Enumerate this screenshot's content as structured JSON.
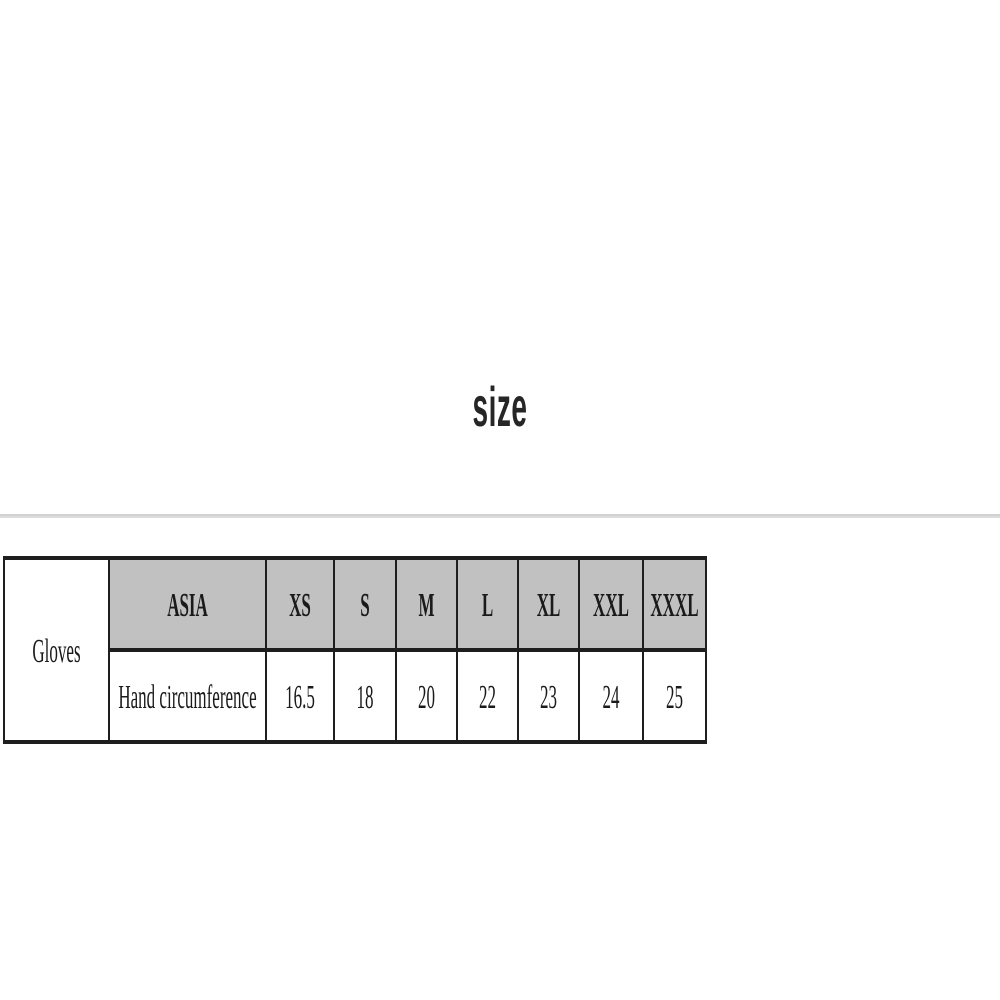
{
  "page": {
    "background": "#ffffff"
  },
  "title": {
    "text": "size",
    "color": "#262626"
  },
  "divider": {
    "color": "#dcdcdc"
  },
  "size_chart": {
    "category": "Gloves",
    "region_header": "ASIA",
    "size_labels": [
      "XS",
      "S",
      "M",
      "L",
      "XL",
      "XXL",
      "XXXL"
    ],
    "measurement_row": {
      "label": "Hand circumference",
      "values": [
        "16.5",
        "18",
        "20",
        "22",
        "23",
        "24",
        "25"
      ]
    },
    "colors": {
      "header_bg": "#c1c1c1",
      "border": "#1e1e1e",
      "text": "#1a1a1a"
    }
  }
}
